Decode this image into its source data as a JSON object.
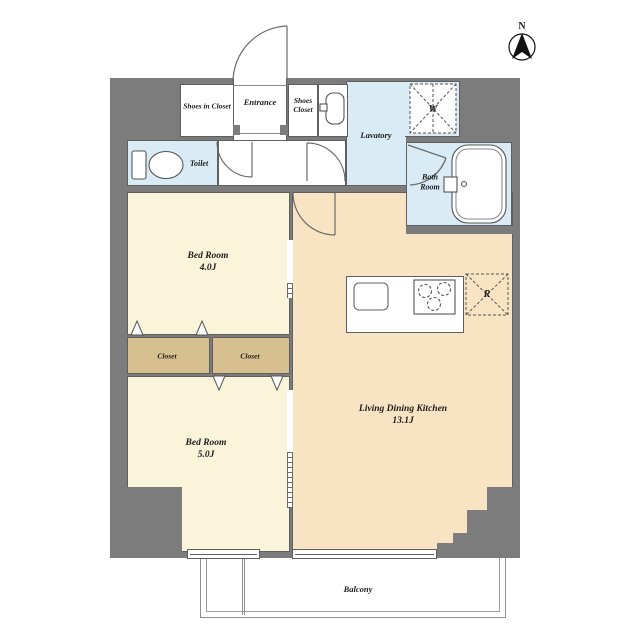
{
  "compass": {
    "label": "N"
  },
  "rooms": {
    "shoes_in_closet": {
      "label": "Shoes in Closet"
    },
    "entrance": {
      "label": "Entrance"
    },
    "shoes_closet": {
      "label": "Shoes Closet"
    },
    "lavatory": {
      "label": "Lavatory"
    },
    "toilet": {
      "label": "Toilet"
    },
    "bath_room": {
      "label": "Bath Room"
    },
    "bed_room_4": {
      "label": "Bed Room",
      "size": "4.0J"
    },
    "bed_room_5": {
      "label": "Bed Room",
      "size": "5.0J"
    },
    "living_dining_kitchen": {
      "label": "Living Dining Kitchen",
      "size": "13.1J"
    },
    "closet_left": {
      "label": "Closet"
    },
    "closet_right": {
      "label": "Closet"
    },
    "balcony": {
      "label": "Balcony"
    }
  },
  "fixtures": {
    "washing_machine": {
      "label": "W"
    },
    "refrigerator": {
      "label": "R"
    }
  },
  "colors": {
    "wall": "#7c7c7c",
    "bedroom_floor": "#faf4da",
    "ldk_floor": "#f8e3c3",
    "closet_floor": "#d8bf90",
    "wet_area_floor": "#d9ecf5",
    "outline": "#5f5f5f"
  }
}
